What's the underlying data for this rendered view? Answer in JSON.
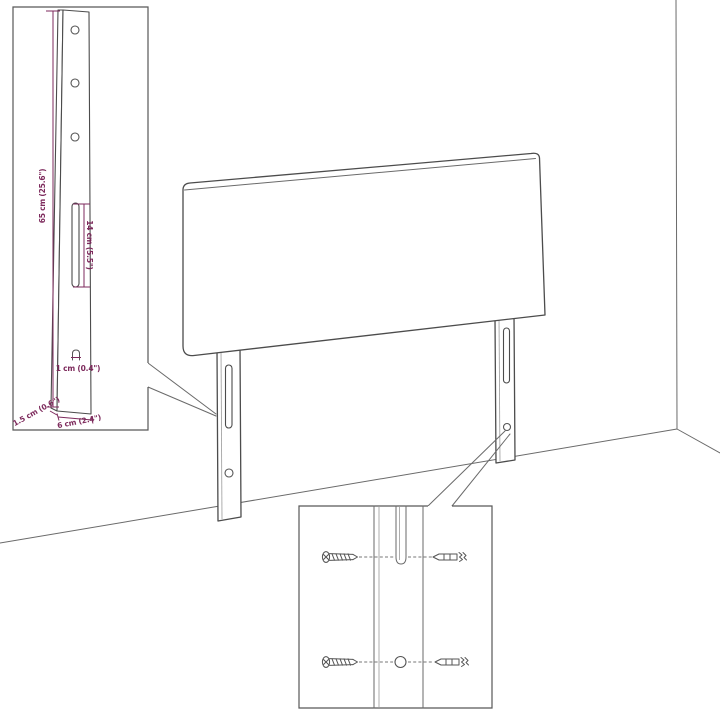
{
  "diagram_title": "headboard-assembly-dimension-diagram",
  "colors": {
    "background": "#ffffff",
    "line": "#4c4c4c",
    "line_light": "#9a9a9a",
    "dimension_text": "#7d2a5c"
  },
  "leg_detail_inset": {
    "height_label": "65 cm (25.6\")",
    "slot_length_label": "14 cm (5.5\")",
    "slot_width_label": "1 cm (0.4\")",
    "thickness_label": "1.5 cm (0.6\")",
    "depth_label": "6 cm (2.4\")",
    "icons": [
      "leg-front-face",
      "leg-side-face",
      "screw-hole-icon",
      "mount-slot-icon",
      "slot-section-icon"
    ]
  },
  "mount_detail_inset": {
    "icons": [
      "screw-icon",
      "wall-plug-icon",
      "mount-slot-icon",
      "screw-hole-icon",
      "leg-strip"
    ]
  },
  "scene": {
    "objects": [
      "headboard-panel",
      "left-leg",
      "right-leg",
      "room-corner",
      "floor-line"
    ]
  }
}
